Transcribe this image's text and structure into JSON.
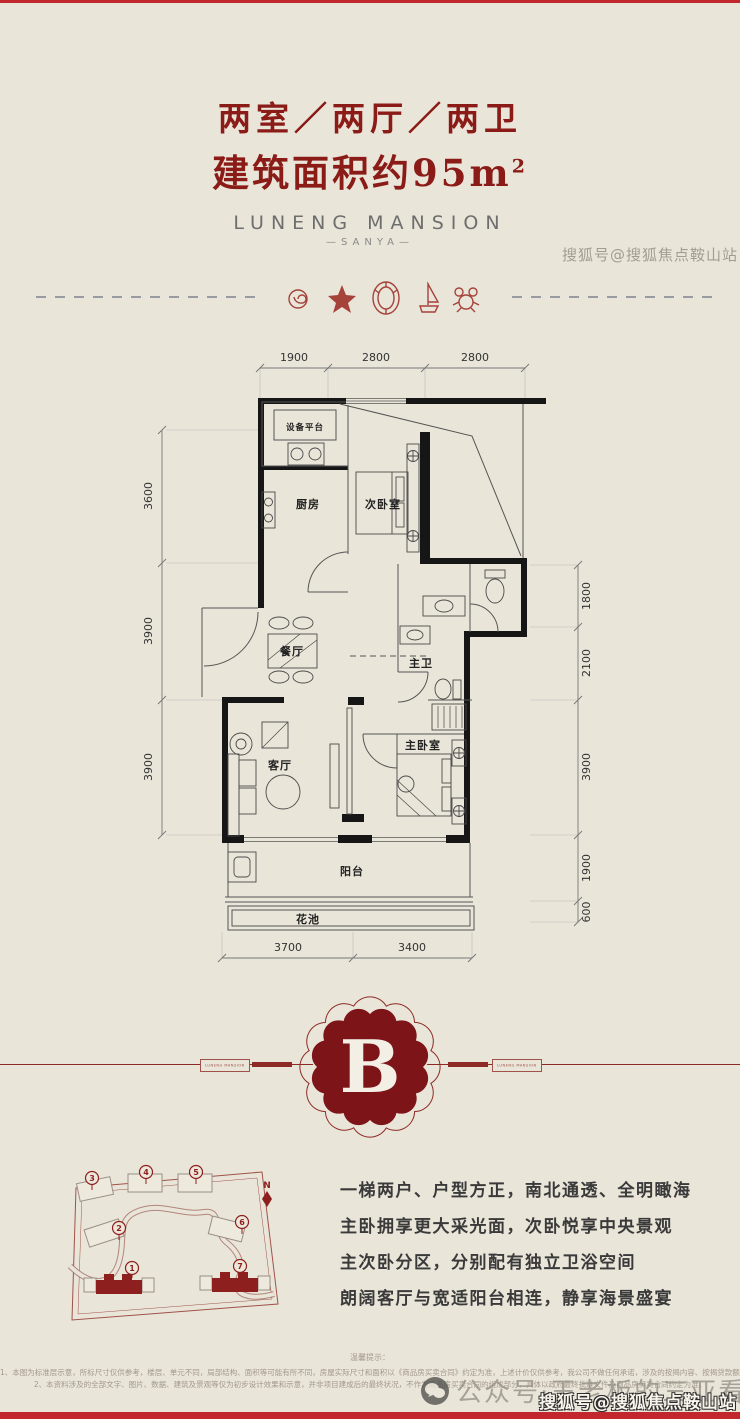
{
  "colors": {
    "background": "#e9e5d9",
    "accent_dark_red": "#8a1b17",
    "bright_red": "#c1272d",
    "map_red": "#a0524a",
    "wall_black": "#161616"
  },
  "header": {
    "title": "两室／两厅／两卫",
    "subtitle": "建筑面积约95m",
    "subtitle_sup": "2",
    "brand": "LUNENG MANSION",
    "brand_sub": "—SANYA—"
  },
  "divider": {
    "icons": [
      "spiral-shell-icon",
      "starfish-icon",
      "clam-shell-icon",
      "sailboat-icon",
      "crab-icon"
    ]
  },
  "floorplan": {
    "rooms": {
      "equipment": "设备平台",
      "kitchen": "厨房",
      "bedroom2": "次卧室",
      "dining": "餐厅",
      "master_bath": "主卫",
      "living": "客厅",
      "master_bedroom": "主卧室",
      "balcony": "阳台",
      "flower_bed": "花池"
    },
    "dims": {
      "top": [
        "1900",
        "2800",
        "2800"
      ],
      "left": [
        "3600",
        "3900",
        "3900"
      ],
      "right": [
        "1800",
        "2100",
        "3900",
        "1900",
        "600"
      ],
      "bottom": [
        "3700",
        "3400"
      ]
    }
  },
  "badge": {
    "letter": "B",
    "ribbon_label": "LUNENG MANSION"
  },
  "sitemap": {
    "north": "N",
    "pins": [
      {
        "label": "1"
      },
      {
        "label": "2"
      },
      {
        "label": "3"
      },
      {
        "label": "4"
      },
      {
        "label": "5"
      },
      {
        "label": "6"
      },
      {
        "label": "7"
      }
    ]
  },
  "features": {
    "lines": [
      "一梯两户、户型方正，南北通透、全明瞰海",
      "主卧拥享更大采光面，次卧悦享中央景观",
      "主次卧分区，分别配有独立卫浴空间",
      "朗阔客厅与宽适阳台相连，静享海景盛宴"
    ]
  },
  "disclaimer": {
    "title": "温馨提示：",
    "lines": [
      "1、本图为标准层示意，所标尺寸仅供参考，楼层、单元不同，局部结构、面积等可能有所不同，房屋实际尺寸和面积以《商品房买卖合同》约定为准，上述计价仅供参考，我公司不做任何承诺，涉及的按揭内容、按揭贷款额度以银行或公积金中心的审批为准。",
      "2、本资料涉及的全部文字、图片、数据、建筑及景观等仅为初步设计效果和示意，并非项目建成后的最终状况，不作为商品房买卖合同的组成部分，具体以政府最终批准文件及商品房买卖合同约定为准。"
    ]
  },
  "watermarks": {
    "top_right": "搜狐号@搜狐焦点鞍山站",
    "bottom_center": "公众号·王老板的三亚看房记",
    "bottom_right": "搜狐号@搜狐焦点鞍山站"
  }
}
